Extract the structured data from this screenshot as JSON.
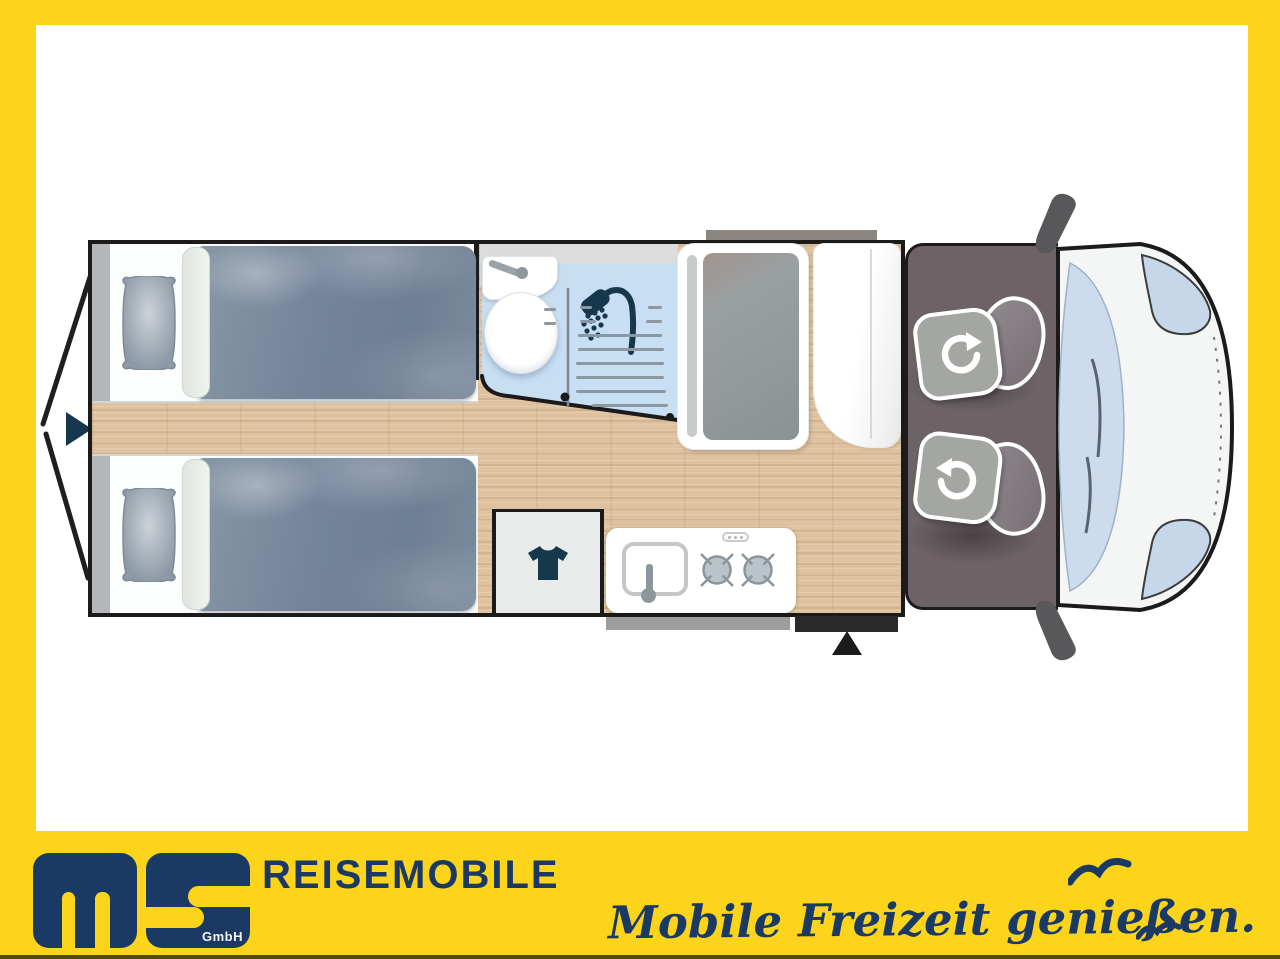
{
  "branding": {
    "logo_letters": "ms",
    "logo_suffix": "GmbH",
    "company": "REISEMOBILE",
    "slogan": "Mobile Freizeit genießen."
  },
  "palette": {
    "frame_yellow": "#FDD41C",
    "brand_navy": "#1B3A63",
    "wood_floor": "#DFC3A0",
    "bathroom_blue": "#C8DEF2",
    "bathroom_band_gray": "#DCDCDC",
    "cab_floor_gray": "#6D6367",
    "duvet_gray_blue": "#7B8B9B",
    "seat_gray": "#A3A6A1",
    "outline_black": "#1B1B1B",
    "icon_teal_navy": "#16384C"
  },
  "floorplan": {
    "icons": [
      {
        "name": "rear-door-swing-lines",
        "meaning": "rear doors opening angle"
      },
      {
        "name": "rear-entry-arrow-icon",
        "meaning": "rear entry direction"
      },
      {
        "name": "shower-head-icon",
        "meaning": "shower"
      },
      {
        "name": "tshirt-icon",
        "meaning": "clothes cabinet"
      },
      {
        "name": "burner-icon",
        "meaning": "two-ring gas hob",
        "count": 2
      },
      {
        "name": "rotate-arrow-icon",
        "meaning": "swivel cab seat",
        "count": 2
      },
      {
        "name": "entry-step-arrow-icon",
        "meaning": "habitation door / step"
      },
      {
        "name": "seagull-icon",
        "count": 2
      }
    ],
    "features": [
      "twin single beds with pillows",
      "washroom with basin, toilet and shower",
      "wardrobe",
      "tall cabinet / fridge",
      "kitchen block with sink and two-burner hob",
      "entry step",
      "two swivel cab seats",
      "cab front with windscreen and mirrors"
    ]
  }
}
